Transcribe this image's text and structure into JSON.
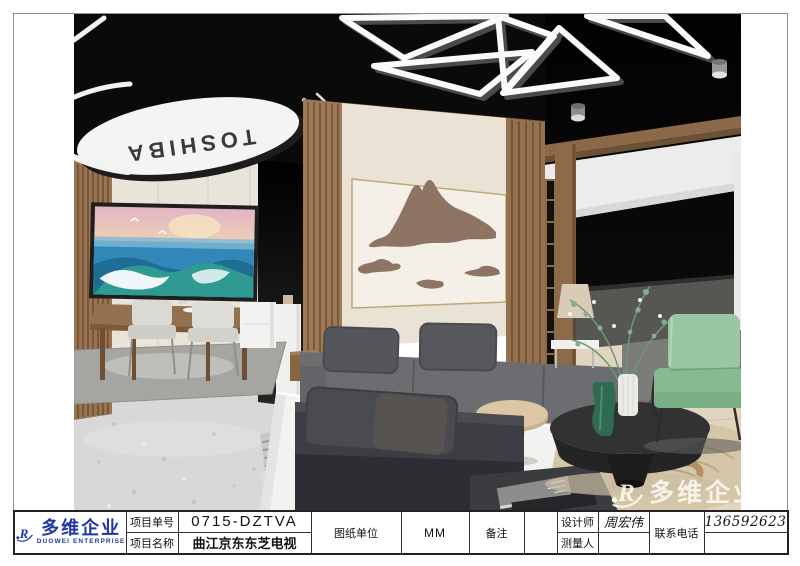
{
  "sheet": {
    "logo": {
      "cn": "多维企业",
      "en": "DUOWEI ENTERPRISE",
      "color": "#2036a0"
    },
    "fields": {
      "project_no_label": "项目单号",
      "project_no": "0715-DZTVA",
      "project_name_label": "项目名称",
      "project_name": "曲江京东东芝电视",
      "unit_label": "图纸单位",
      "unit": "MM",
      "remark_label": "备注",
      "remark": "",
      "designer_label": "设计师",
      "designer": "周宏伟",
      "surveyor_label": "测量人",
      "surveyor": "",
      "phone_label": "联系电话",
      "phone": "13659262305"
    }
  },
  "scene": {
    "sign_text": "TOSHIBA",
    "watermark": "多维企业",
    "colors": {
      "ceiling": "#0a0a0a",
      "wood": "#9a7451",
      "cream_wall": "#e9e4d9",
      "terrazzo": "#d8d8d6",
      "sofa_gray": "#6b6d71",
      "sofa_dark": "#3c3e43",
      "armchair_green": "#8cbd96",
      "mountain_art": "#8d7463"
    }
  }
}
